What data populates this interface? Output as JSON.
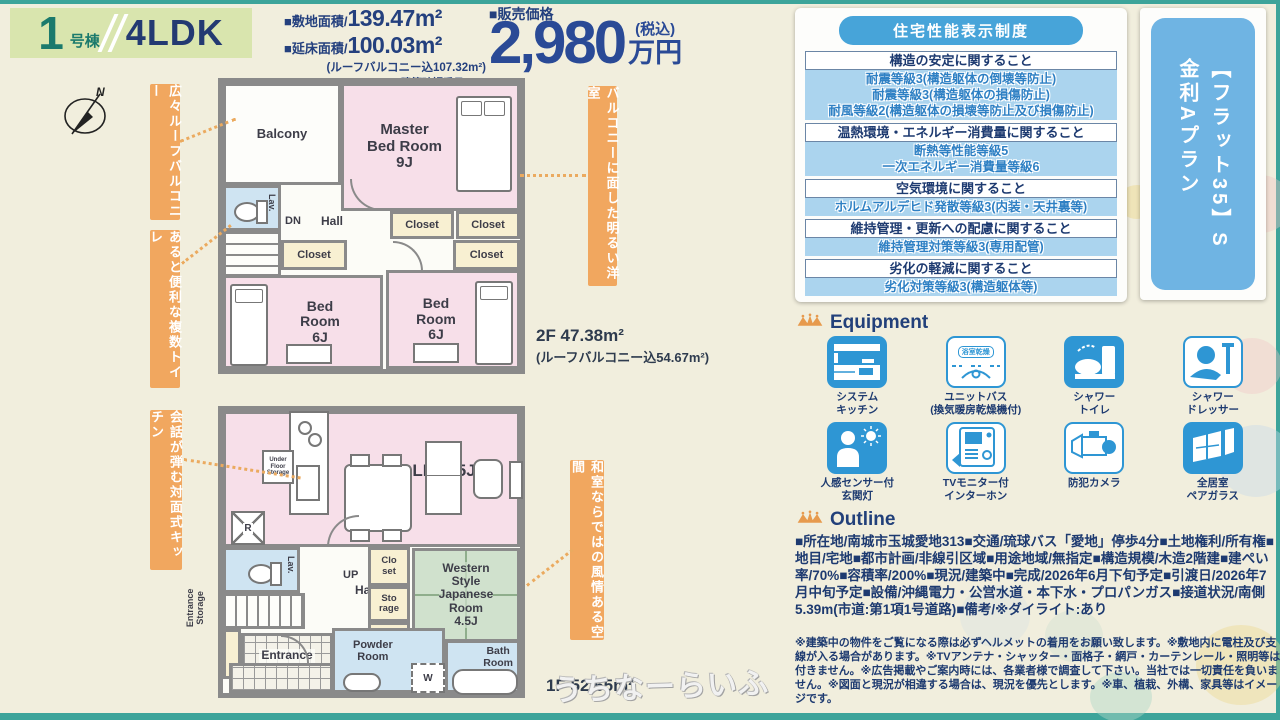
{
  "colors": {
    "accent_teal": "#3da49a",
    "navy": "#1d3a70",
    "price_navy": "#2a4a96",
    "orange_ribbon": "#f1a75f",
    "table_blue": "#47a4d9",
    "row_blue": "#abd4ee",
    "banner_blue": "#6fb4e3",
    "room_pink": "#f7dfe9",
    "room_cream": "#f8f0d2",
    "room_wet": "#cfe4f2",
    "room_green": "#d0e1cd"
  },
  "header": {
    "unit_number": "1",
    "unit_suffix": "号棟",
    "layout": "4LDK",
    "land_label": "■敷地面積/",
    "land_value": "139.47m²",
    "floor_label": "■延床面積/",
    "floor_value": "100.03m²",
    "floor_note": "(ルーフバルコニー込107.32m²)",
    "confirmation": "建築確認番号/●●●",
    "price_label": "■販売価格",
    "price_value": "2,980",
    "price_tax": "(税込)",
    "price_unit": "万円"
  },
  "performance": {
    "title": "住宅性能表示制度",
    "groups": [
      {
        "category": "構造の安定に関すること",
        "grades": [
          "耐震等級3(構造躯体の倒壊等防止)",
          "耐震等級3(構造躯体の損傷防止)",
          "耐風等級2(構造躯体の損壊等防止及び損傷防止)"
        ]
      },
      {
        "category": "温熱環境・エネルギー消費量に関すること",
        "grades": [
          "断熱等性能等級5",
          "一次エネルギー消費量等級6"
        ]
      },
      {
        "category": "空気環境に関すること",
        "grades": [
          "ホルムアルデヒド発散等級3(内装・天井裏等)"
        ]
      },
      {
        "category": "維持管理・更新への配慮に関すること",
        "grades": [
          "維持管理対策等級3(専用配管)"
        ]
      },
      {
        "category": "劣化の軽減に関すること",
        "grades": [
          "劣化対策等級3(構造躯体等)"
        ]
      }
    ]
  },
  "flat35": {
    "line1": "【フラット35】S",
    "line2": "金利Aプラン"
  },
  "equipment": {
    "title": "Equipment",
    "items": [
      {
        "label": "システム\nキッチン",
        "icon": "system-kitchen"
      },
      {
        "label": "ユニットバス\n(換気暖房乾燥機付)",
        "icon": "unit-bath",
        "badge": "浴室乾燥"
      },
      {
        "label": "シャワー\nトイレ",
        "icon": "shower-toilet"
      },
      {
        "label": "シャワー\nドレッサー",
        "icon": "shower-dresser"
      },
      {
        "label": "人感センサー付\n玄関灯",
        "icon": "motion-sensor-light"
      },
      {
        "label": "TVモニター付\nインターホン",
        "icon": "tv-intercom"
      },
      {
        "label": "防犯カメラ",
        "icon": "security-camera"
      },
      {
        "label": "全居室\nペアガラス",
        "icon": "pair-glass"
      }
    ]
  },
  "outline": {
    "title": "Outline",
    "details": "■所在地/南城市玉城愛地313■交通/琉球バス「愛地」停歩4分■土地権利/所有権■地目/宅地■都市計画/非線引区域■用途地域/無指定■構造規模/木造2階建■建ぺい率/70%■容積率/200%■現況/建築中■完成/2026年6月下旬予定■引渡日/2026年7月中旬予定■設備/沖縄電力・公営水道・本下水・プロパンガス■接道状況/南側5.39m(市道:第1項1号道路)■備考/※ダイライト:あり",
    "notes": "※建築中の物件をご覧になる際は必ずヘルメットの着用をお願い致します。※敷地内に電柱及び支線が入る場合があります。※TVアンテナ・シャッター・面格子・網戸・カーテンレール・照明等は付きません。※広告掲載やご案内時には、各業者様で調査して下さい。当社では一切責任を負いません。※図面と現況が相違する場合は、現況を優先とします。※車、植栽、外構、家具等はイメージです。"
  },
  "plans": {
    "f2": {
      "area_label": "2F 47.38m²",
      "area_note": "(ルーフバルコニー込54.67m²)",
      "balcony": "Balcony",
      "master": "Master\nBed Room\n9J",
      "lav": "Lav.",
      "dn": "DN",
      "hall": "Hall",
      "closet": "Closet",
      "bed_left": "Bed\nRoom\n6J",
      "bed_right": "Bed\nRoom\n6J"
    },
    "f1": {
      "area_label": "1F 52.65m²",
      "ldk": "LDK15J",
      "under_floor": "Under\nFloor\nStorage",
      "fridge": "R",
      "lav": "Lav.",
      "up": "UP",
      "hall": "Hall",
      "entrance_storage": "Entrance\nStorage",
      "entrance": "Entrance",
      "closet": "Clo\nset",
      "storage": "Sto\nrage",
      "western": "Western\nStyle\nJapanese\nRoom\n4.5J",
      "powder": "Powder\nRoom",
      "washer": "W",
      "bath": "Bath\nRoom"
    }
  },
  "callouts": {
    "c1": "広々ルーフバルコニー",
    "c2": "あると便利な複数トイレ",
    "c3": "会話が弾む対面式キッチン",
    "c4": "バルコニーに面した明るい洋室",
    "c5": "和室ならではの風情ある空間"
  },
  "compass": {
    "label": "N"
  },
  "watermark": {
    "text": "うちなーらいふ"
  }
}
